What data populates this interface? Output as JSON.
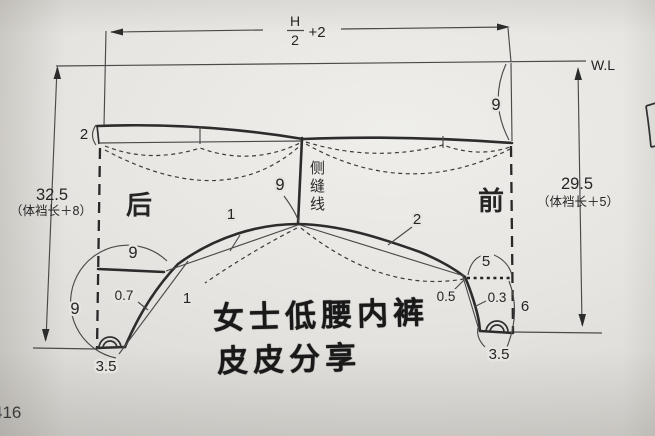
{
  "page": {
    "number": "416"
  },
  "watermark": {
    "line1": "女士低腰内裤",
    "line2": "皮皮分享"
  },
  "dimensions": {
    "top_width": {
      "numerator": "H",
      "denominator": "2",
      "suffix": "+2"
    },
    "waistline": "W.L",
    "back_length": {
      "value": "32.5",
      "formula": "（体裆长＋8）"
    },
    "front_length": {
      "value": "29.5",
      "formula": "（体裆长＋5）"
    }
  },
  "labels": {
    "back": "后",
    "front": "前",
    "side_seam": "侧缝线",
    "back_band_height": "2",
    "front_waist_drop": "9",
    "side_seam_depth": "9",
    "back_leg_width": "9",
    "back_crotch_depth": "9",
    "arch_offset_left": "1",
    "arch_offset_right": "2",
    "back_leg_drop": "1",
    "back_curve_offset": "0.7",
    "front_leg_offset": "0.5",
    "front_curve_offset": "0.3",
    "front_tab_width": "5",
    "front_tab_depth": "6",
    "back_crotch_width": "3.5",
    "front_crotch_width": "3.5"
  }
}
